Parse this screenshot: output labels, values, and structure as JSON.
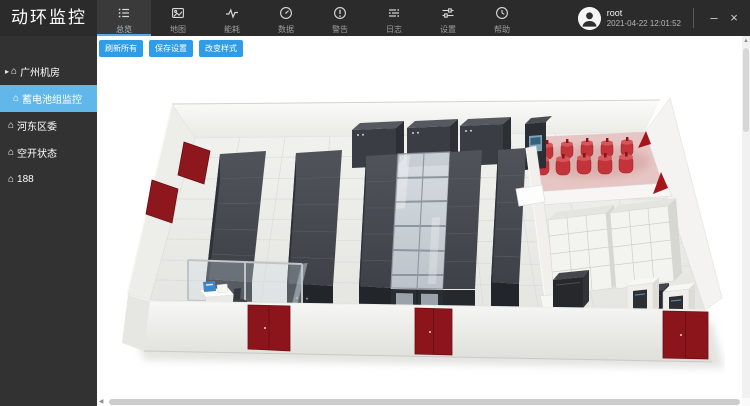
{
  "app": {
    "title": "动环监控"
  },
  "topnav": {
    "items": [
      {
        "label": "总览",
        "icon": "overview-list-icon",
        "active": true
      },
      {
        "label": "地图",
        "icon": "map-image-icon",
        "active": false
      },
      {
        "label": "能耗",
        "icon": "energy-wave-icon",
        "active": false
      },
      {
        "label": "数据",
        "icon": "data-gauge-icon",
        "active": false
      },
      {
        "label": "警告",
        "icon": "alert-circle-icon",
        "active": false
      },
      {
        "label": "日志",
        "icon": "logs-lines-icon",
        "active": false
      },
      {
        "label": "设置",
        "icon": "settings-sliders-icon",
        "active": false
      },
      {
        "label": "帮助",
        "icon": "help-clock-icon",
        "active": false
      }
    ]
  },
  "user": {
    "name": "root",
    "timestamp": "2021-04-22 12:01:52"
  },
  "window_controls": {
    "minimize": "–",
    "close": "×"
  },
  "sidebar": {
    "items": [
      {
        "label": "广州机房",
        "level": 0,
        "expanded": true,
        "selected": false
      },
      {
        "label": "蓄电池组监控",
        "level": 1,
        "expanded": false,
        "selected": true
      },
      {
        "label": "河东区委",
        "level": 0,
        "expanded": false,
        "selected": false
      },
      {
        "label": "空开状态",
        "level": 0,
        "expanded": false,
        "selected": false
      },
      {
        "label": "188",
        "level": 0,
        "expanded": false,
        "selected": false
      }
    ]
  },
  "toolbar": {
    "buttons": [
      "刷新所有",
      "保存设置",
      "改变样式"
    ]
  },
  "scene": {
    "description_icons": [
      "server-rack",
      "cold-aisle-glass-roof",
      "gas-cylinders",
      "battery-racks",
      "ups-cabinets",
      "red-doors",
      "office-area"
    ]
  },
  "colors": {
    "topbar_bg": "#2b2b2b",
    "sidebar_bg": "#323232",
    "accent_blue": "#2f9ce8",
    "selected_item_blue": "#62b7ea",
    "nav_active_underline": "#55abe6",
    "door_red": "#8c151b",
    "cylinder_red": "#c23439"
  }
}
